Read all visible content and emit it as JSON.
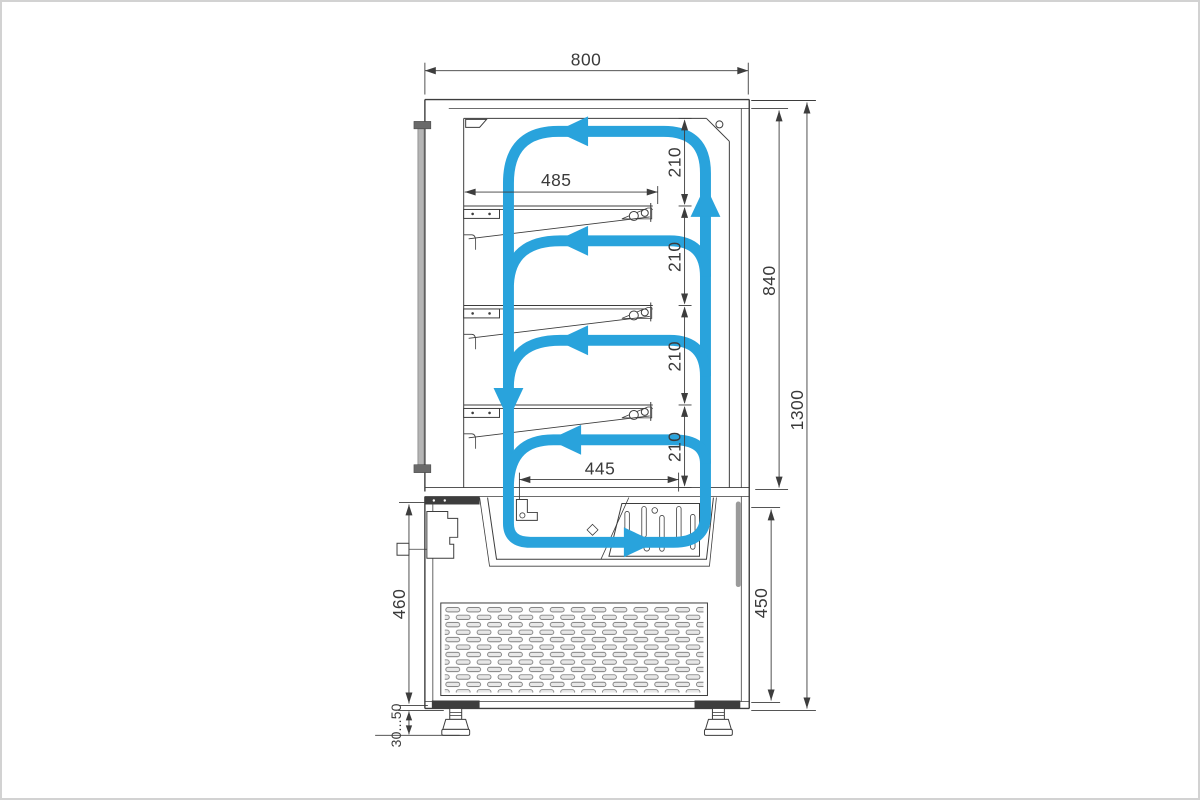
{
  "drawing": {
    "subject": "refrigerated-display-case-cross-section-with-air-circulation",
    "units": "mm",
    "colors": {
      "line": "#3d3d3d",
      "airflow": "#29a3dc",
      "glass": "#b5b5b5",
      "background": "#ffffff"
    },
    "dims": {
      "overall_width": "800",
      "shelf_width": "485",
      "gap_1": "210",
      "gap_2": "210",
      "gap_3": "210",
      "gap_4": "210",
      "display_height": "840",
      "overall_height": "1300",
      "return_opening_width": "445",
      "base_inner_height": "450",
      "base_height": "460",
      "leg_adjustment": "30...50"
    }
  }
}
